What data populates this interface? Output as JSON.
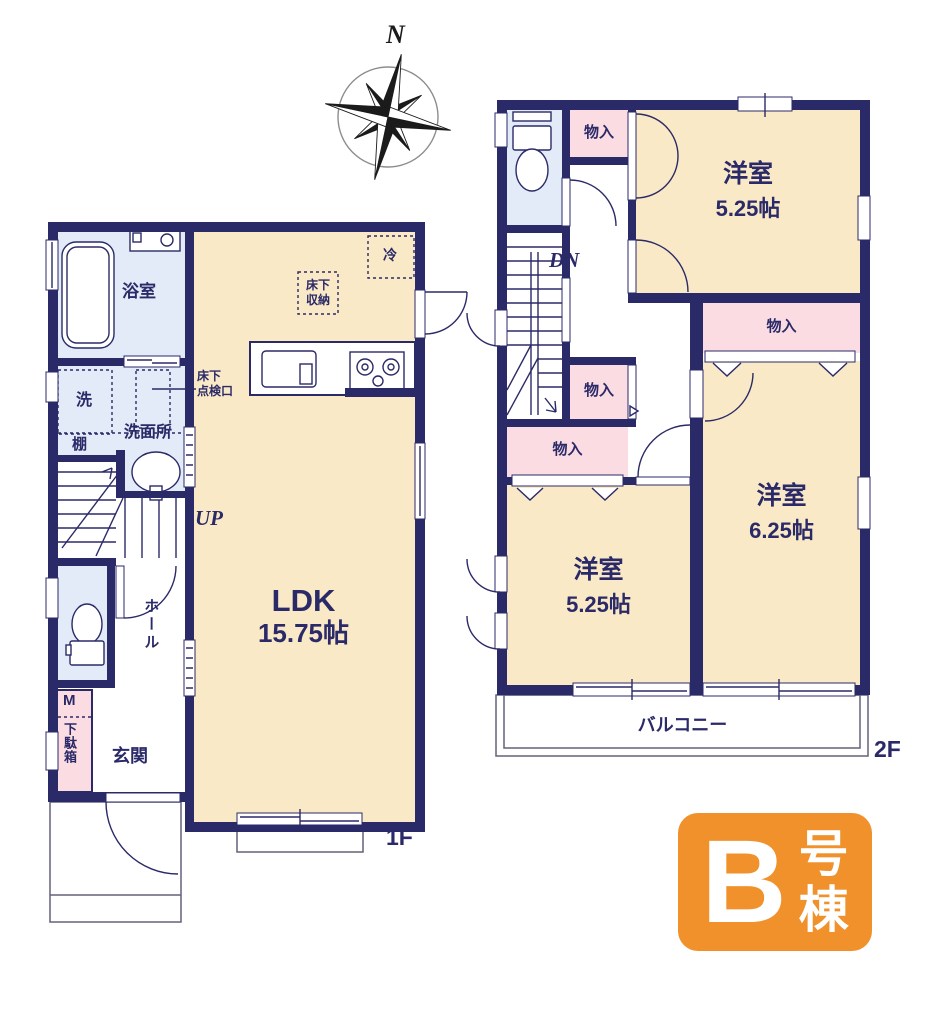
{
  "palette": {
    "wall": "#2b2a68",
    "text_navy": "#2b2a68",
    "room_cream": "#f9e9c6",
    "wet_blue": "#e2ebf7",
    "storage_pink": "#fbdce2",
    "badge_orange": "#f0912c",
    "line_gray": "#62627a"
  },
  "compass": {
    "north_label": "N"
  },
  "floor1": {
    "floor_label": "1F",
    "bathroom": "浴室",
    "laundry": "洗",
    "shelf": "棚",
    "washroom": "洗面所",
    "inspection_hatch": {
      "line1": "床下",
      "line2": "点検口"
    },
    "stairs_up": "UP",
    "hall": "ホール",
    "meter_box": "M",
    "shoe_cabinet": "下駄箱",
    "entrance": "玄関",
    "ldk": {
      "name": "LDK",
      "size": "15.75帖"
    },
    "fridge": "冷",
    "underfloor_storage": {
      "line1": "床下",
      "line2": "収納"
    }
  },
  "floor2": {
    "floor_label": "2F",
    "stairs_down": "DN",
    "balcony": "バルコニー",
    "rooms": [
      {
        "name": "洋室",
        "size": "5.25帖"
      },
      {
        "name": "洋室",
        "size": "6.25帖"
      },
      {
        "name": "洋室",
        "size": "5.25帖"
      }
    ],
    "storages": [
      "物入",
      "物入",
      "物入",
      "物入"
    ]
  },
  "badge": {
    "letter": "B",
    "suffix": [
      "号",
      "棟"
    ]
  }
}
